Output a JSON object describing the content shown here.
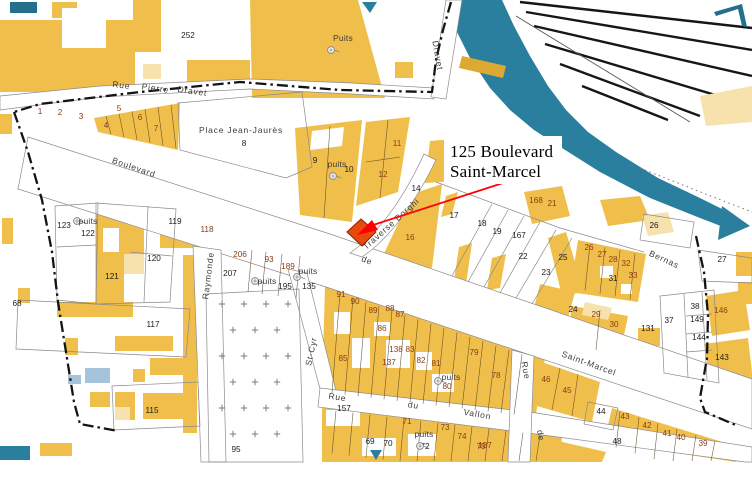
{
  "annotation": {
    "line1": "125 Boulevard",
    "line2": "Saint-Marcel",
    "arrow_color": "#ff0000",
    "highlight_color": "#e8490f"
  },
  "colors": {
    "building": "#f0bf4b",
    "building_light": "#f7e2ad",
    "water": "#2a7f9e",
    "water_light": "#a5c3da",
    "parcel_number_black": "#1c1c1c",
    "parcel_number_red": "#8b3a15",
    "boundary": "#141414"
  },
  "map": {
    "street_labels": [
      {
        "t": "Rue",
        "x": 121,
        "y": 88,
        "r": 7,
        "s": 8
      },
      {
        "t": "Pierre",
        "x": 155,
        "y": 91,
        "r": 8,
        "s": 8
      },
      {
        "t": "Dravet",
        "x": 192,
        "y": 94,
        "r": 8,
        "s": 8
      },
      {
        "t": "Dravet",
        "x": 435,
        "y": 56,
        "r": 80,
        "s": 8
      },
      {
        "t": "Boulevard",
        "x": 133,
        "y": 170,
        "r": 19,
        "s": 9.5
      },
      {
        "t": "de",
        "x": 366,
        "y": 263,
        "r": 22,
        "s": 9.5
      },
      {
        "t": "Saint-Marcel",
        "x": 588,
        "y": 366,
        "r": 20,
        "s": 9.5
      },
      {
        "t": "Place Jean-Jaurès",
        "x": 241,
        "y": 133,
        "r": 0,
        "s": 8.3
      },
      {
        "t": "Traverse Borghi",
        "x": 393,
        "y": 226,
        "r": -42,
        "s": 7.8
      },
      {
        "t": "Raymonde",
        "x": 211,
        "y": 276,
        "r": -83,
        "s": 8.3
      },
      {
        "t": "St-Cyr",
        "x": 314,
        "y": 352,
        "r": -78,
        "s": 8.3
      },
      {
        "t": "Rue",
        "x": 337,
        "y": 400,
        "r": 9,
        "s": 9
      },
      {
        "t": "du",
        "x": 413,
        "y": 408,
        "r": 9,
        "s": 9
      },
      {
        "t": "Vallon",
        "x": 477,
        "y": 417,
        "r": 10,
        "s": 9
      },
      {
        "t": "Rue",
        "x": 523,
        "y": 371,
        "r": 80,
        "s": 8.3
      },
      {
        "t": "de",
        "x": 538,
        "y": 436,
        "r": 80,
        "s": 8.3
      },
      {
        "t": "Bernas",
        "x": 663,
        "y": 262,
        "r": 24,
        "s": 8
      }
    ],
    "parcel_numbers": [
      {
        "n": "252",
        "x": 188,
        "y": 38,
        "c": "k",
        "s": 10
      },
      {
        "n": "1",
        "x": 40,
        "y": 114,
        "c": "r"
      },
      {
        "n": "2",
        "x": 60,
        "y": 115,
        "c": "r"
      },
      {
        "n": "3",
        "x": 81,
        "y": 119,
        "c": "r"
      },
      {
        "n": "4",
        "x": 106,
        "y": 128,
        "c": "r"
      },
      {
        "n": "5",
        "x": 119,
        "y": 111,
        "c": "r"
      },
      {
        "n": "6",
        "x": 140,
        "y": 120,
        "c": "r"
      },
      {
        "n": "7",
        "x": 156,
        "y": 131,
        "c": "r"
      },
      {
        "n": "8",
        "x": 244,
        "y": 146,
        "c": "k"
      },
      {
        "n": "9",
        "x": 315,
        "y": 163,
        "c": "k"
      },
      {
        "n": "10",
        "x": 349,
        "y": 172,
        "c": "k"
      },
      {
        "n": "11",
        "x": 397,
        "y": 146,
        "c": "r"
      },
      {
        "n": "12",
        "x": 383,
        "y": 177,
        "c": "r"
      },
      {
        "n": "13",
        "x": 448,
        "y": 160,
        "c": "r"
      },
      {
        "n": "14",
        "x": 416,
        "y": 191,
        "c": "k"
      },
      {
        "n": "16",
        "x": 410,
        "y": 240,
        "c": "r"
      },
      {
        "n": "17",
        "x": 454,
        "y": 218,
        "c": "k"
      },
      {
        "n": "18",
        "x": 482,
        "y": 226,
        "c": "k"
      },
      {
        "n": "19",
        "x": 497,
        "y": 234,
        "c": "k"
      },
      {
        "n": "167",
        "x": 519,
        "y": 238,
        "c": "k"
      },
      {
        "n": "168",
        "x": 536,
        "y": 203,
        "c": "r"
      },
      {
        "n": "21",
        "x": 552,
        "y": 206,
        "c": "r"
      },
      {
        "n": "22",
        "x": 523,
        "y": 259,
        "c": "k"
      },
      {
        "n": "23",
        "x": 546,
        "y": 275,
        "c": "k"
      },
      {
        "n": "25",
        "x": 563,
        "y": 260,
        "c": "k"
      },
      {
        "n": "26",
        "x": 589,
        "y": 250,
        "c": "r"
      },
      {
        "n": "26",
        "x": 654,
        "y": 228,
        "c": "k"
      },
      {
        "n": "27",
        "x": 602,
        "y": 257,
        "c": "r"
      },
      {
        "n": "28",
        "x": 613,
        "y": 262,
        "c": "r"
      },
      {
        "n": "32",
        "x": 626,
        "y": 266,
        "c": "r"
      },
      {
        "n": "31",
        "x": 613,
        "y": 281,
        "c": "k"
      },
      {
        "n": "33",
        "x": 633,
        "y": 278,
        "c": "r"
      },
      {
        "n": "27",
        "x": 722,
        "y": 262,
        "c": "k"
      },
      {
        "n": "24",
        "x": 573,
        "y": 312,
        "c": "k"
      },
      {
        "n": "29",
        "x": 596,
        "y": 317,
        "c": "r"
      },
      {
        "n": "30",
        "x": 614,
        "y": 327,
        "c": "r",
        "s": 9
      },
      {
        "n": "131",
        "x": 648,
        "y": 331,
        "c": "k",
        "s": 9
      },
      {
        "n": "37",
        "x": 669,
        "y": 323,
        "c": "k",
        "s": 9
      },
      {
        "n": "38",
        "x": 695,
        "y": 309,
        "c": "k",
        "s": 9
      },
      {
        "n": "149",
        "x": 697,
        "y": 322,
        "c": "k"
      },
      {
        "n": "144",
        "x": 699,
        "y": 340,
        "c": "k"
      },
      {
        "n": "146",
        "x": 721,
        "y": 313,
        "c": "r",
        "s": 9
      },
      {
        "n": "143",
        "x": 722,
        "y": 360,
        "c": "k",
        "s": 9
      },
      {
        "n": "68",
        "x": 17,
        "y": 306,
        "c": "k",
        "s": 9.5
      },
      {
        "n": "123",
        "x": 64,
        "y": 228,
        "c": "k",
        "s": 9
      },
      {
        "n": "122",
        "x": 88,
        "y": 236,
        "c": "k",
        "s": 9
      },
      {
        "n": "119",
        "x": 175,
        "y": 224,
        "c": "k",
        "s": 9
      },
      {
        "n": "118",
        "x": 207,
        "y": 232,
        "c": "r",
        "s": 9
      },
      {
        "n": "120",
        "x": 154,
        "y": 261,
        "c": "k",
        "s": 9
      },
      {
        "n": "121",
        "x": 112,
        "y": 279,
        "c": "k",
        "s": 9
      },
      {
        "n": "117",
        "x": 153,
        "y": 327,
        "c": "k",
        "s": 9.5
      },
      {
        "n": "115",
        "x": 152,
        "y": 413,
        "c": "k",
        "s": 9.5
      },
      {
        "n": "95",
        "x": 236,
        "y": 452,
        "c": "k"
      },
      {
        "n": "206",
        "x": 240,
        "y": 257,
        "c": "r",
        "s": 9
      },
      {
        "n": "207",
        "x": 230,
        "y": 276,
        "c": "k",
        "s": 9
      },
      {
        "n": "93",
        "x": 269,
        "y": 262,
        "c": "r",
        "s": 9
      },
      {
        "n": "189",
        "x": 288,
        "y": 269,
        "c": "r",
        "s": 9
      },
      {
        "n": "195",
        "x": 285,
        "y": 289,
        "c": "k"
      },
      {
        "n": "135",
        "x": 309,
        "y": 289,
        "c": "k",
        "s": 9
      },
      {
        "n": "91",
        "x": 341,
        "y": 297,
        "c": "r"
      },
      {
        "n": "90",
        "x": 355,
        "y": 304,
        "c": "r",
        "s": 9
      },
      {
        "n": "89",
        "x": 373,
        "y": 313,
        "c": "r"
      },
      {
        "n": "88",
        "x": 390,
        "y": 311,
        "c": "r"
      },
      {
        "n": "87",
        "x": 400,
        "y": 317,
        "c": "r"
      },
      {
        "n": "86",
        "x": 382,
        "y": 331,
        "c": "r"
      },
      {
        "n": "85",
        "x": 343,
        "y": 361,
        "c": "r",
        "s": 9
      },
      {
        "n": "138",
        "x": 396,
        "y": 352,
        "c": "r"
      },
      {
        "n": "83",
        "x": 410,
        "y": 352,
        "c": "r"
      },
      {
        "n": "137",
        "x": 389,
        "y": 365,
        "c": "r"
      },
      {
        "n": "82",
        "x": 421,
        "y": 363,
        "c": "r"
      },
      {
        "n": "81",
        "x": 436,
        "y": 366,
        "c": "r"
      },
      {
        "n": "80",
        "x": 447,
        "y": 389,
        "c": "r"
      },
      {
        "n": "79",
        "x": 474,
        "y": 355,
        "c": "r"
      },
      {
        "n": "78",
        "x": 496,
        "y": 378,
        "c": "r",
        "s": 9
      },
      {
        "n": "157",
        "x": 344,
        "y": 411,
        "c": "k",
        "s": 9
      },
      {
        "n": "71",
        "x": 407,
        "y": 424,
        "c": "r"
      },
      {
        "n": "69",
        "x": 370,
        "y": 444,
        "c": "k"
      },
      {
        "n": "70",
        "x": 388,
        "y": 446,
        "c": "k"
      },
      {
        "n": "72",
        "x": 425,
        "y": 449,
        "c": "k"
      },
      {
        "n": "73",
        "x": 445,
        "y": 430,
        "c": "r"
      },
      {
        "n": "74",
        "x": 462,
        "y": 439,
        "c": "r"
      },
      {
        "n": "75",
        "x": 481,
        "y": 449,
        "c": "r"
      },
      {
        "n": "187",
        "x": 485,
        "y": 448,
        "c": "r"
      },
      {
        "n": "46",
        "x": 546,
        "y": 382,
        "c": "r"
      },
      {
        "n": "45",
        "x": 567,
        "y": 393,
        "c": "r"
      },
      {
        "n": "44",
        "x": 601,
        "y": 414,
        "c": "k"
      },
      {
        "n": "43",
        "x": 625,
        "y": 419,
        "c": "r"
      },
      {
        "n": "42",
        "x": 647,
        "y": 428,
        "c": "r"
      },
      {
        "n": "41",
        "x": 667,
        "y": 436,
        "c": "r"
      },
      {
        "n": "40",
        "x": 681,
        "y": 440,
        "c": "r"
      },
      {
        "n": "39",
        "x": 703,
        "y": 446,
        "c": "r"
      },
      {
        "n": "48",
        "x": 617,
        "y": 444,
        "c": "k"
      }
    ],
    "wells": [
      {
        "t": "Puits",
        "tx": 343,
        "ty": 41,
        "sx": 331,
        "sy": 50,
        "fs": 8.5
      },
      {
        "t": "puits",
        "tx": 337,
        "ty": 167,
        "sx": 333,
        "sy": 176,
        "fs": 7.5
      },
      {
        "t": "puits",
        "tx": 88,
        "ty": 224,
        "sx": 77,
        "sy": 221,
        "fs": 7.5
      },
      {
        "t": "puits",
        "tx": 267,
        "ty": 284,
        "sx": 255,
        "sy": 281,
        "fs": 7.5
      },
      {
        "t": "puits",
        "tx": 308,
        "ty": 274,
        "sx": 297,
        "sy": 277,
        "fs": 7.5
      },
      {
        "t": "puits",
        "tx": 451,
        "ty": 380,
        "sx": 438,
        "sy": 381,
        "fs": 7.5
      },
      {
        "t": "puits",
        "tx": 424,
        "ty": 437,
        "sx": 420,
        "sy": 446,
        "fs": 7.5
      }
    ],
    "cemetery": {
      "x": 222,
      "y": 304,
      "cols": 4,
      "rows": 7,
      "dx": 22,
      "dy": 26
    }
  }
}
